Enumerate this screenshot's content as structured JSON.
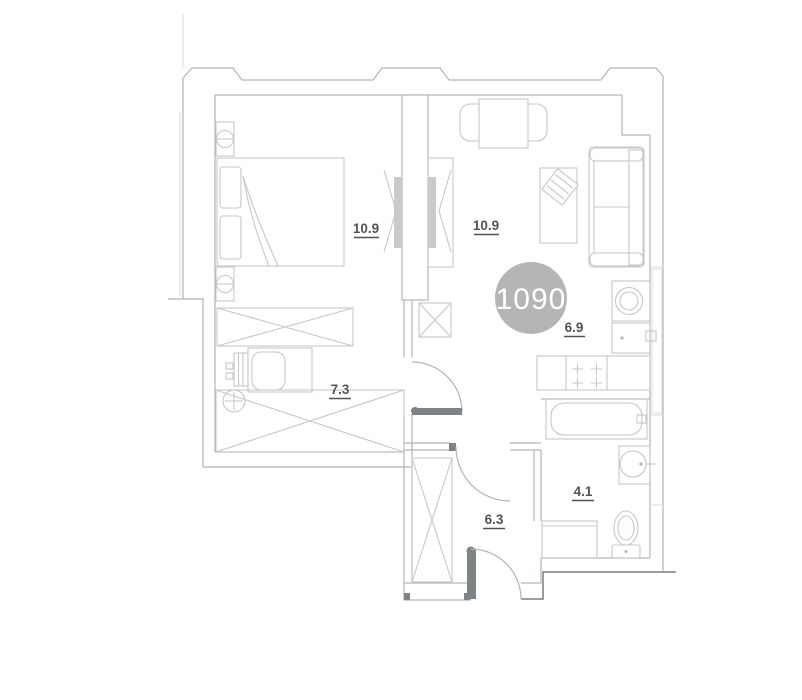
{
  "floor_plan": {
    "unit_badge": {
      "number": "1090"
    },
    "room_areas": {
      "bedroom": "10.9",
      "living_room": "10.9",
      "kitchen": "6.9",
      "study": "7.3",
      "hallway": "6.3",
      "bathroom": "4.1"
    },
    "colors": {
      "badge_fill": "#b5b5b5",
      "badge_text": "#ffffff",
      "label_text": "#4f5355",
      "wall_line": "#b2b6b6",
      "dark_line": "#8d9293"
    }
  }
}
